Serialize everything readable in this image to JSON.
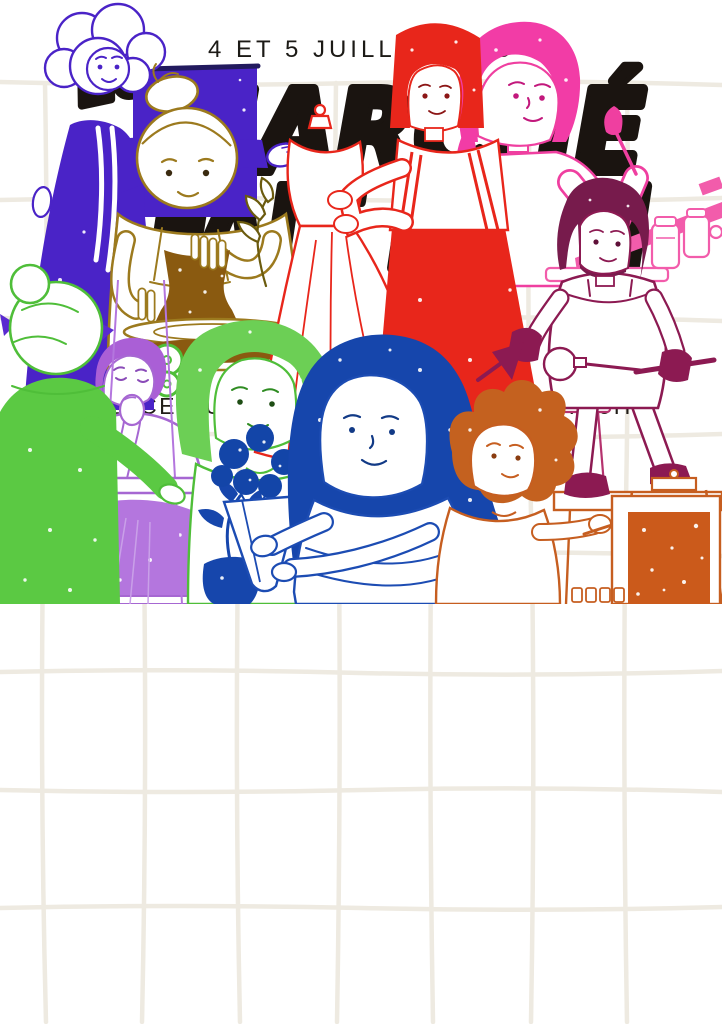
{
  "poster": {
    "date_line": "4 ET 5 JUILLET 2025",
    "title": {
      "article": "Le",
      "line1": "MARCHÉ",
      "line2": "FAIT MAIN"
    },
    "info": {
      "location": "PLACE DU 8 SEPTEMBRE",
      "divider": "|",
      "hours": "DE 9H A 19H"
    }
  },
  "palette": {
    "background": "#ffffff",
    "grid_line": "#eeeae1",
    "ink": "#1a1410",
    "purple": "#4a23c7",
    "ochre": "#9c7a1e",
    "clay_brown": "#8a5a10",
    "red": "#e8261b",
    "pink": "#ef3fa0",
    "magenta_hair": "#f23ca6",
    "maroon": "#8c1a52",
    "green": "#5bc943",
    "light_green": "#a8dd92",
    "violet": "#a667d2",
    "blue": "#1c4cb3",
    "dark_blue_hair": "#1646ac",
    "orange": "#c65e20",
    "orange_canvas": "#cb5a1b"
  },
  "illustrations": [
    {
      "name": "purple-artist-woman",
      "desc": "woman in purple dress presenting a purple canvas"
    },
    {
      "name": "potter-woman",
      "desc": "woman shaping a brown clay pot on a pottery wheel"
    },
    {
      "name": "dress-mannequin",
      "desc": "white dress form with red outline"
    },
    {
      "name": "red-dressmaker",
      "desc": "red bob-haired woman fitting a dress"
    },
    {
      "name": "pink-painter",
      "desc": "magenta-haired woman holding a paintbrush"
    },
    {
      "name": "craft-shelf-jars",
      "desc": "pink shelf with jars and tools"
    },
    {
      "name": "maroon-artisan-girl",
      "desc": "girl with gloves working glass over a bench"
    },
    {
      "name": "green-knitter",
      "desc": "green-sweater figure seen from behind"
    },
    {
      "name": "violet-weaver",
      "desc": "seated violet woman at a loom"
    },
    {
      "name": "green-haired-woman",
      "desc": "woman with green hair"
    },
    {
      "name": "blue-florist",
      "desc": "blue-haired woman wrapping a blue bouquet"
    },
    {
      "name": "orange-child-painter",
      "desc": "orange-haired child painting an orange canvas"
    }
  ]
}
